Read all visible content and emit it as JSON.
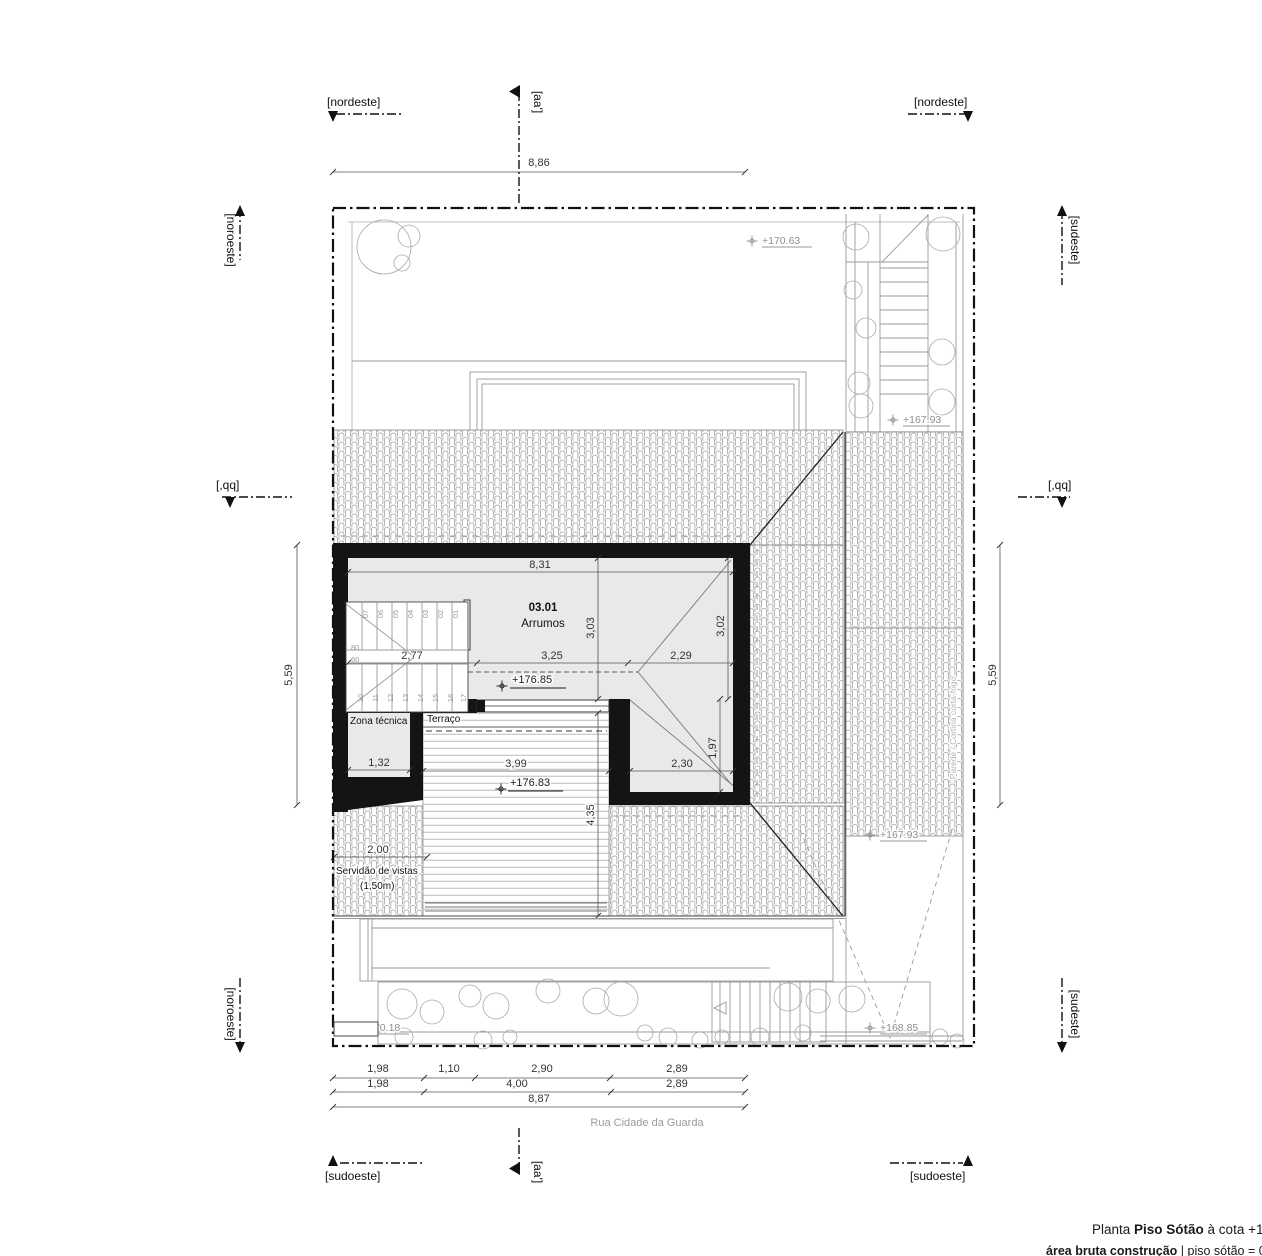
{
  "drawing": {
    "title_prefix": "Planta ",
    "title_bold": "Piso Sótão",
    "title_suffix": " à cota +17",
    "subtitle_bold": "área bruta construção",
    "subtitle_rest": " | piso sótão = 03",
    "street": "Rua Cidade da Guarda"
  },
  "colors": {
    "wall": "#141414",
    "room_fill": "#e9e9e9",
    "line_gray": "#999999",
    "level_gray": "#8f8f8f"
  },
  "orientation": {
    "nordeste_left": "[nordeste]",
    "nordeste_right": "[nordeste]",
    "noroeste_top": "[noroeste]",
    "noroeste_bottom": "[noroeste]",
    "sudeste_top": "[sudeste]",
    "sudeste_bottom": "[sudeste]",
    "sudoeste_left": "[sudoeste]",
    "sudoeste_right": "[sudoeste]",
    "section_aa_top": "[aa']",
    "section_aa_bottom": "[aa']",
    "section_qq_left": "[,qq]",
    "section_qq_right": "[,qq]"
  },
  "rooms": {
    "main_number": "03.01",
    "main_name": "Arrumos",
    "tech": "Zona técnica",
    "terrace": "Terraço",
    "firewall": "Parede / Cortina corta-fogo",
    "easement_1": "Servidão de vistas",
    "easement_2": "(1,50m)"
  },
  "levels": {
    "top_yard": "+170.63",
    "court_upper": "+167.93",
    "attic": "+176.85",
    "terrace": "+176.83",
    "drive_upper": "+167.93",
    "garden": "+170.18",
    "drive_lower": "+168.85"
  },
  "dims": {
    "top": "8,86",
    "side_left": "5,59",
    "side_right": "5,59",
    "room_width": "8,31",
    "room_depth": "3,03",
    "room_depth2": "3,02",
    "stair_width": "2,77",
    "room_mid": "3,25",
    "room_right": "2,29",
    "tech_width": "1,32",
    "terrace_width": "3,99",
    "terrace_depth": "4,35",
    "leg_width": "2,30",
    "leg_depth": "1,97",
    "easement": "2,00",
    "b1a": "1,98",
    "b1b": "1,10",
    "b1c": "2,90",
    "b1d": "2,89",
    "b2a": "1,98",
    "b2b": "4,00",
    "b2c": "2,89",
    "b3": "8,87"
  },
  "stairs": {
    "riser_width": "80",
    "riser_depth": "60",
    "top": [
      "07",
      "06",
      "05",
      "04",
      "03",
      "02",
      "01"
    ],
    "bottom": [
      "10",
      "11",
      "12",
      "13",
      "14",
      "15",
      "16",
      "17"
    ]
  }
}
